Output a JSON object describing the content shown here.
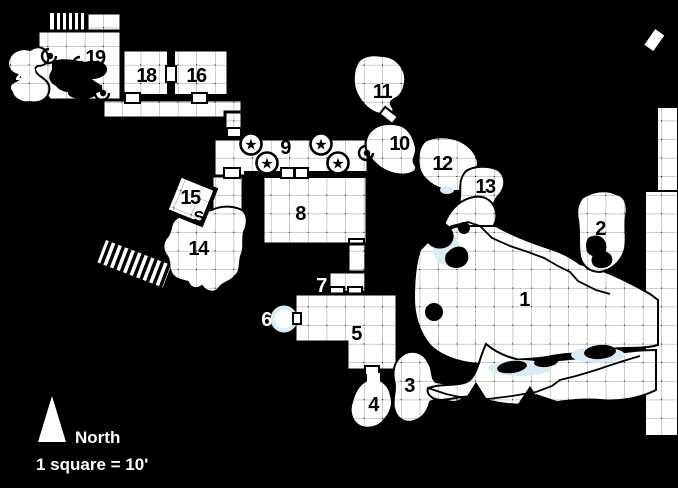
{
  "map": {
    "legend": {
      "north_label": "North",
      "scale_label": "1 square = 10'"
    },
    "rooms": {
      "r1": {
        "label": "1"
      },
      "r2": {
        "label": "2"
      },
      "r3": {
        "label": "3"
      },
      "r4": {
        "label": "4"
      },
      "r5": {
        "label": "5"
      },
      "r6": {
        "label": "6"
      },
      "r7": {
        "label": "7"
      },
      "r8": {
        "label": "8"
      },
      "r9": {
        "label": "9"
      },
      "r10": {
        "label": "10"
      },
      "r11": {
        "label": "11"
      },
      "r12": {
        "label": "12"
      },
      "r13": {
        "label": "13"
      },
      "r14": {
        "label": "14"
      },
      "r15": {
        "label": "15"
      },
      "r16": {
        "label": "16"
      },
      "r18": {
        "label": "18"
      },
      "r19": {
        "label": "19"
      },
      "r20": {
        "label": "20"
      }
    },
    "symbols": {
      "secret_door": "S",
      "star": "★"
    },
    "colors": {
      "background": "#000000",
      "room_fill": "#ffffff",
      "grid_line": "#9a9a9a",
      "water": "#d9ecf5",
      "label_dark": "#000000",
      "label_light": "#ffffff"
    }
  }
}
